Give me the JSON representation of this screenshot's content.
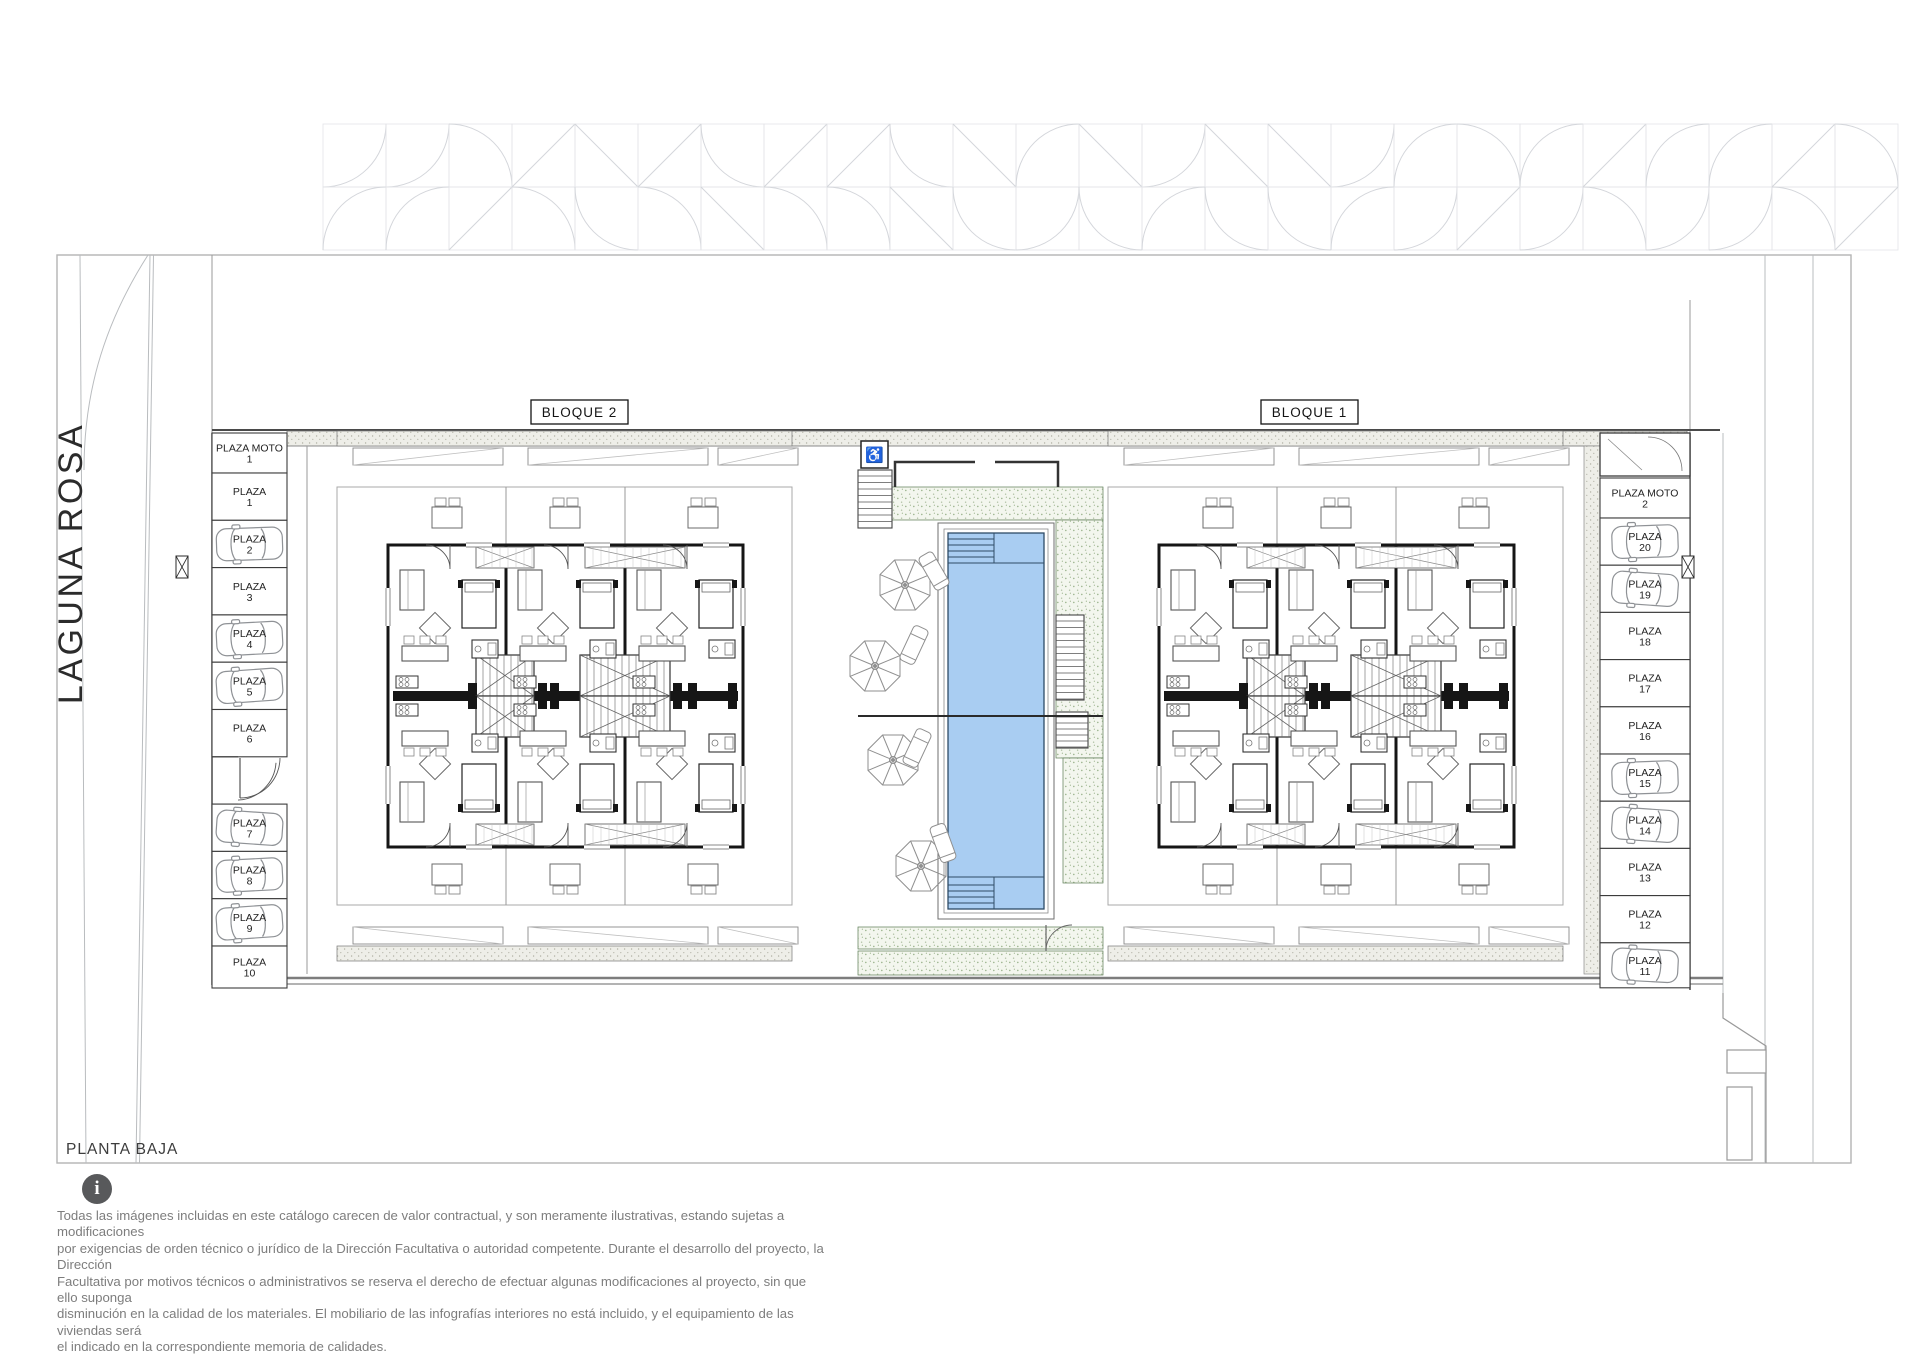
{
  "page": {
    "plan_label": "PLANTA BAJA"
  },
  "street": {
    "name": "LAGUNA ROSA"
  },
  "blocks": [
    {
      "label": "BLOQUE 2"
    },
    {
      "label": "BLOQUE 1"
    }
  ],
  "courtyard": {
    "elevator_icon": "♿",
    "pool_color": "#a9cdf2"
  },
  "parking": {
    "left": [
      {
        "label": "PLAZA MOTO",
        "number": "1",
        "car": false
      },
      {
        "label": "PLAZA",
        "number": "1",
        "car": false
      },
      {
        "label": "PLAZA",
        "number": "2",
        "car": true
      },
      {
        "label": "PLAZA",
        "number": "3",
        "car": false
      },
      {
        "label": "PLAZA",
        "number": "4",
        "car": true
      },
      {
        "label": "PLAZA",
        "number": "5",
        "car": true
      },
      {
        "label": "PLAZA",
        "number": "6",
        "car": false
      },
      {
        "gap": true
      },
      {
        "label": "PLAZA",
        "number": "7",
        "car": true
      },
      {
        "label": "PLAZA",
        "number": "8",
        "car": true
      },
      {
        "label": "PLAZA",
        "number": "9",
        "car": true
      },
      {
        "label": "PLAZA",
        "number": "10",
        "car": false
      }
    ],
    "right": [
      {
        "gap": true
      },
      {
        "label": "PLAZA MOTO",
        "number": "2",
        "car": false
      },
      {
        "label": "PLAZA",
        "number": "20",
        "car": true
      },
      {
        "label": "PLAZA",
        "number": "19",
        "car": true
      },
      {
        "label": "PLAZA",
        "number": "18",
        "car": false
      },
      {
        "label": "PLAZA",
        "number": "17",
        "car": false
      },
      {
        "label": "PLAZA",
        "number": "16",
        "car": false
      },
      {
        "label": "PLAZA",
        "number": "15",
        "car": true
      },
      {
        "label": "PLAZA",
        "number": "14",
        "car": true
      },
      {
        "label": "PLAZA",
        "number": "13",
        "car": false
      },
      {
        "label": "PLAZA",
        "number": "12",
        "car": false
      },
      {
        "label": "PLAZA",
        "number": "11",
        "car": true
      }
    ]
  },
  "footer": {
    "info_icon": "i",
    "disclaimer_lines": [
      "Todas las imágenes incluidas en este catálogo carecen de valor contractual, y son meramente ilustrativas, estando sujetas a modificaciones",
      "por exigencias de orden técnico o jurídico de la Dirección Facultativa o autoridad competente. Durante el desarrollo del proyecto, la Dirección",
      "Facultativa por motivos técnicos o administrativos se reserva el derecho de efectuar algunas modificaciones al proyecto, sin que ello suponga",
      "disminución en la calidad de los materiales. El mobiliario de las infografías interiores no está incluido, y el equipamiento de las viviendas será",
      "el indicado en la correspondiente memoria de calidades."
    ]
  },
  "colors": {
    "wall": "#161616",
    "pool_water": "#a9cdf2",
    "pool_edge": "#2e4b66",
    "deck_dot": "#9db48f",
    "road": "#b4b7ba",
    "tile": "#dbdde1",
    "info_circle": "#58595b"
  }
}
